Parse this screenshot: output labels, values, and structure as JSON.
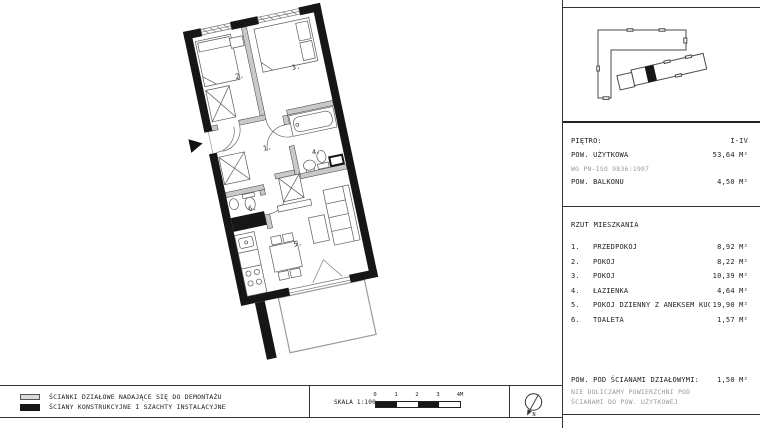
{
  "plan": {
    "room_labels": [
      "1.",
      "2.",
      "3.",
      "4.",
      "5.",
      "6."
    ]
  },
  "info": {
    "floor_label": "PIĘTRO:",
    "floor_value": "I-IV",
    "area_label": "POW. UŻYTKOWA",
    "area_value": "53,64 M²",
    "area_note": "WG PN-ISO 9836:1997",
    "balcony_label": "POW. BALKONU",
    "balcony_value": "4,50 M²"
  },
  "rooms": {
    "title": "RZUT MIESZKANIA",
    "items": [
      {
        "num": "1.",
        "name": "PRZEDPOKÓJ",
        "area": "8,92 M²"
      },
      {
        "num": "2.",
        "name": "POKÓJ",
        "area": "8,22 M²"
      },
      {
        "num": "3.",
        "name": "POKÓJ",
        "area": "10,39 M²"
      },
      {
        "num": "4.",
        "name": "ŁAZIENKA",
        "area": "4,64 M²"
      },
      {
        "num": "5.",
        "name": "POKÓJ DZIENNY Z ANEKSEM KUCHENNYM",
        "area": "19,90 M²"
      },
      {
        "num": "6.",
        "name": "TOALETA",
        "area": "1,57 M²"
      }
    ]
  },
  "walls_note": {
    "label": "POW. POD ŚCIANAMI DZIAŁOWYMI:",
    "value": "1,50 M²",
    "note_line1": "NIE DOLICZAMY POWIERZCHNI POD",
    "note_line2": "ŚCIANAMI DO POW. UŻYTKOWEJ"
  },
  "legend": {
    "items": [
      {
        "label": "ŚCIANKI DZIAŁOWE NADAJĄCE SIĘ DO DEMONTAŻU"
      },
      {
        "label": "ŚCIANY KONSTRUKCYJNE I SZACHTY INSTALACYJNE"
      }
    ]
  },
  "scale": {
    "label": "SKALA 1:100",
    "ticks": [
      "0",
      "1",
      "2",
      "3",
      "4M"
    ]
  },
  "compass": {
    "north_label": "N"
  },
  "colors": {
    "structural_wall": "#161616",
    "partition_wall": "#c9c9c9",
    "balcony_outline": "#9b9b9b",
    "secondary_text": "#9a9a9a"
  }
}
